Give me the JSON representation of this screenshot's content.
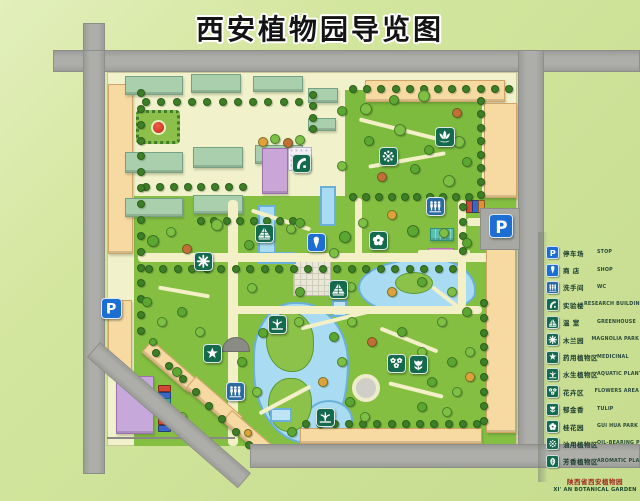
{
  "title": "西安植物园导览图",
  "footer": {
    "org_zh": "陕西省西安植物园",
    "org_en": "XI' AN BOTANICAL GARDEN"
  },
  "legend": {
    "items": [
      {
        "zh": "停车场",
        "en": "STOP",
        "icon": "parking",
        "bg": "#1d6ed2"
      },
      {
        "zh": "商 店",
        "en": "SHOP",
        "icon": "shop",
        "bg": "#1d6ed2"
      },
      {
        "zh": "洗手间",
        "en": "WC",
        "icon": "wc",
        "bg": "#2a6a9e"
      },
      {
        "zh": "实验楼",
        "en": "RESEARCH BUILDING",
        "icon": "research",
        "bg": "#156a4e"
      },
      {
        "zh": "温 室",
        "en": "GREENHOUSE",
        "icon": "greenhouse",
        "bg": "#156a4e"
      },
      {
        "zh": "木兰园",
        "en": "MAGNOLIA PARK",
        "icon": "magnolia",
        "bg": "#156a4e"
      },
      {
        "zh": "药用植物区",
        "en": "MEDICINAL",
        "icon": "star",
        "bg": "#156a4e"
      },
      {
        "zh": "水生植物区",
        "en": "AQUATIC PLANTS",
        "icon": "aquatic",
        "bg": "#156a4e"
      },
      {
        "zh": "花卉区",
        "en": "FLOWERS AREA",
        "icon": "flowers",
        "bg": "#156a4e"
      },
      {
        "zh": "郁金香",
        "en": "TULIP",
        "icon": "tulip",
        "bg": "#156a4e"
      },
      {
        "zh": "桂花园",
        "en": "GUI HUA PARK",
        "icon": "sakura",
        "bg": "#156a4e"
      },
      {
        "zh": "油用植物区",
        "en": "OIL-BEARING PLANTS",
        "icon": "oil",
        "bg": "#156a4e"
      },
      {
        "zh": "芳香植物区",
        "en": "AROMATIC PLANTS",
        "icon": "aromatic",
        "bg": "#156a4e"
      }
    ]
  },
  "map": {
    "markers": [
      {
        "name": "west-parking-sign",
        "icon": "parking",
        "x": 101,
        "y": 298,
        "s": 21,
        "bg": "#1d6ed2"
      },
      {
        "name": "east-parking-sign",
        "icon": "parking",
        "x": 489,
        "y": 214,
        "s": 24,
        "bg": "#1d6ed2"
      },
      {
        "name": "shop-marker",
        "icon": "shop",
        "x": 307,
        "y": 233,
        "s": 19,
        "bg": "#1d6ed2"
      },
      {
        "name": "wc-north-marker",
        "icon": "wc",
        "x": 426,
        "y": 197,
        "s": 19,
        "bg": "#2a6a9e"
      },
      {
        "name": "wc-south-marker",
        "icon": "wc",
        "x": 226,
        "y": 382,
        "s": 19,
        "bg": "#2a6a9e"
      },
      {
        "name": "research-building-marker",
        "icon": "research",
        "x": 292,
        "y": 154,
        "s": 19,
        "bg": "#156a4e"
      },
      {
        "name": "greenhouse-marker-1",
        "icon": "greenhouse",
        "x": 255,
        "y": 224,
        "s": 19,
        "bg": "#156a4e"
      },
      {
        "name": "greenhouse-marker-2",
        "icon": "greenhouse",
        "x": 329,
        "y": 280,
        "s": 19,
        "bg": "#156a4e"
      },
      {
        "name": "magnolia-park-marker",
        "icon": "magnolia",
        "x": 194,
        "y": 252,
        "s": 19,
        "bg": "#156a4e"
      },
      {
        "name": "lotus-garden-marker",
        "icon": "lotus",
        "x": 435,
        "y": 127,
        "s": 20,
        "bg": "#156a4e"
      },
      {
        "name": "oil-bearing-marker",
        "icon": "oil",
        "x": 379,
        "y": 147,
        "s": 19,
        "bg": "#156a4e"
      },
      {
        "name": "gui-hua-park-marker",
        "icon": "sakura",
        "x": 369,
        "y": 231,
        "s": 19,
        "bg": "#156a4e"
      },
      {
        "name": "medicinal-marker",
        "icon": "star",
        "x": 203,
        "y": 344,
        "s": 19,
        "bg": "#156a4e"
      },
      {
        "name": "aquatic-marker-1",
        "icon": "aquatic",
        "x": 268,
        "y": 315,
        "s": 19,
        "bg": "#156a4e"
      },
      {
        "name": "aquatic-marker-2",
        "icon": "aquatic",
        "x": 316,
        "y": 408,
        "s": 19,
        "bg": "#156a4e"
      },
      {
        "name": "flowers-area-marker",
        "icon": "flowers",
        "x": 387,
        "y": 354,
        "s": 19,
        "bg": "#156a4e"
      },
      {
        "name": "tulip-area-marker",
        "icon": "tulip",
        "x": 409,
        "y": 355,
        "s": 19,
        "bg": "#156a4e"
      }
    ],
    "tree_rows": [
      [
        145,
        101,
        298,
        101,
        11
      ],
      [
        145,
        186,
        242,
        186,
        8
      ],
      [
        352,
        88,
        508,
        88,
        12
      ],
      [
        480,
        100,
        480,
        194,
        8
      ],
      [
        140,
        92,
        140,
        330,
        16
      ],
      [
        148,
        268,
        452,
        268,
        22
      ],
      [
        305,
        423,
        476,
        423,
        13
      ],
      [
        483,
        302,
        483,
        420,
        9
      ],
      [
        155,
        352,
        248,
        444,
        8
      ],
      [
        200,
        220,
        292,
        220,
        8
      ],
      [
        352,
        196,
        468,
        196,
        10
      ],
      [
        462,
        206,
        462,
        250,
        4
      ],
      [
        312,
        94,
        312,
        128,
        4
      ]
    ],
    "trees": [
      [
        365,
        108,
        5,
        1
      ],
      [
        393,
        99,
        4,
        0
      ],
      [
        423,
        95,
        5,
        1
      ],
      [
        456,
        112,
        4,
        5
      ],
      [
        368,
        140,
        4,
        0
      ],
      [
        399,
        129,
        5,
        1
      ],
      [
        428,
        149,
        4,
        0
      ],
      [
        458,
        141,
        5,
        1
      ],
      [
        381,
        176,
        4,
        5
      ],
      [
        414,
        168,
        4,
        0
      ],
      [
        448,
        180,
        5,
        1
      ],
      [
        466,
        161,
        4,
        0
      ],
      [
        152,
        240,
        5,
        0
      ],
      [
        170,
        231,
        4,
        1
      ],
      [
        186,
        248,
        4,
        5
      ],
      [
        216,
        224,
        5,
        1
      ],
      [
        248,
        244,
        4,
        0
      ],
      [
        290,
        228,
        4,
        1
      ],
      [
        344,
        236,
        5,
        0
      ],
      [
        362,
        222,
        4,
        1
      ],
      [
        391,
        214,
        4,
        3
      ],
      [
        412,
        230,
        5,
        0
      ],
      [
        333,
        252,
        4,
        1
      ],
      [
        299,
        222,
        4,
        0
      ],
      [
        443,
        232,
        4,
        1
      ],
      [
        466,
        242,
        4,
        0
      ],
      [
        251,
        287,
        4,
        1
      ],
      [
        299,
        291,
        4,
        0
      ],
      [
        350,
        286,
        4,
        1
      ],
      [
        391,
        291,
        4,
        3
      ],
      [
        421,
        281,
        4,
        0
      ],
      [
        451,
        291,
        4,
        1
      ],
      [
        466,
        311,
        4,
        0
      ],
      [
        441,
        321,
        4,
        1
      ],
      [
        401,
        331,
        4,
        0
      ],
      [
        371,
        341,
        4,
        5
      ],
      [
        351,
        321,
        4,
        1
      ],
      [
        262,
        332,
        4,
        0
      ],
      [
        298,
        321,
        4,
        1
      ],
      [
        333,
        336,
        4,
        0
      ],
      [
        341,
        361,
        4,
        1
      ],
      [
        322,
        381,
        4,
        3
      ],
      [
        349,
        401,
        4,
        0
      ],
      [
        364,
        416,
        4,
        1
      ],
      [
        291,
        431,
        4,
        0
      ],
      [
        256,
        391,
        4,
        1
      ],
      [
        241,
        361,
        4,
        0
      ],
      [
        421,
        351,
        4,
        1
      ],
      [
        451,
        361,
        4,
        0
      ],
      [
        469,
        351,
        4,
        1
      ],
      [
        431,
        381,
        4,
        0
      ],
      [
        456,
        391,
        4,
        1
      ],
      [
        469,
        376,
        4,
        3
      ],
      [
        421,
        406,
        4,
        0
      ],
      [
        446,
        411,
        4,
        1
      ],
      [
        146,
        301,
        4,
        0
      ],
      [
        161,
        321,
        4,
        1
      ],
      [
        181,
        311,
        4,
        0
      ],
      [
        199,
        331,
        4,
        1
      ],
      [
        152,
        341,
        3,
        0
      ],
      [
        176,
        371,
        4,
        0
      ],
      [
        181,
        416,
        4,
        1
      ],
      [
        190,
        438,
        3,
        0
      ],
      [
        207,
        441,
        3,
        1
      ],
      [
        247,
        432,
        3,
        3
      ],
      [
        262,
        141,
        4,
        3
      ],
      [
        274,
        138,
        4,
        1
      ],
      [
        287,
        142,
        4,
        5
      ],
      [
        299,
        139,
        4,
        1
      ],
      [
        341,
        110,
        4,
        0
      ],
      [
        341,
        165,
        4,
        1
      ]
    ],
    "cars_west": [
      "#d04838",
      "#3a66c8",
      "#3aa8a0",
      "#e09038",
      "#b8b8b8",
      "#d04838",
      "#3a66c8"
    ],
    "cars_east": [
      "#d04838",
      "#3a66c8",
      "#e09038"
    ]
  }
}
